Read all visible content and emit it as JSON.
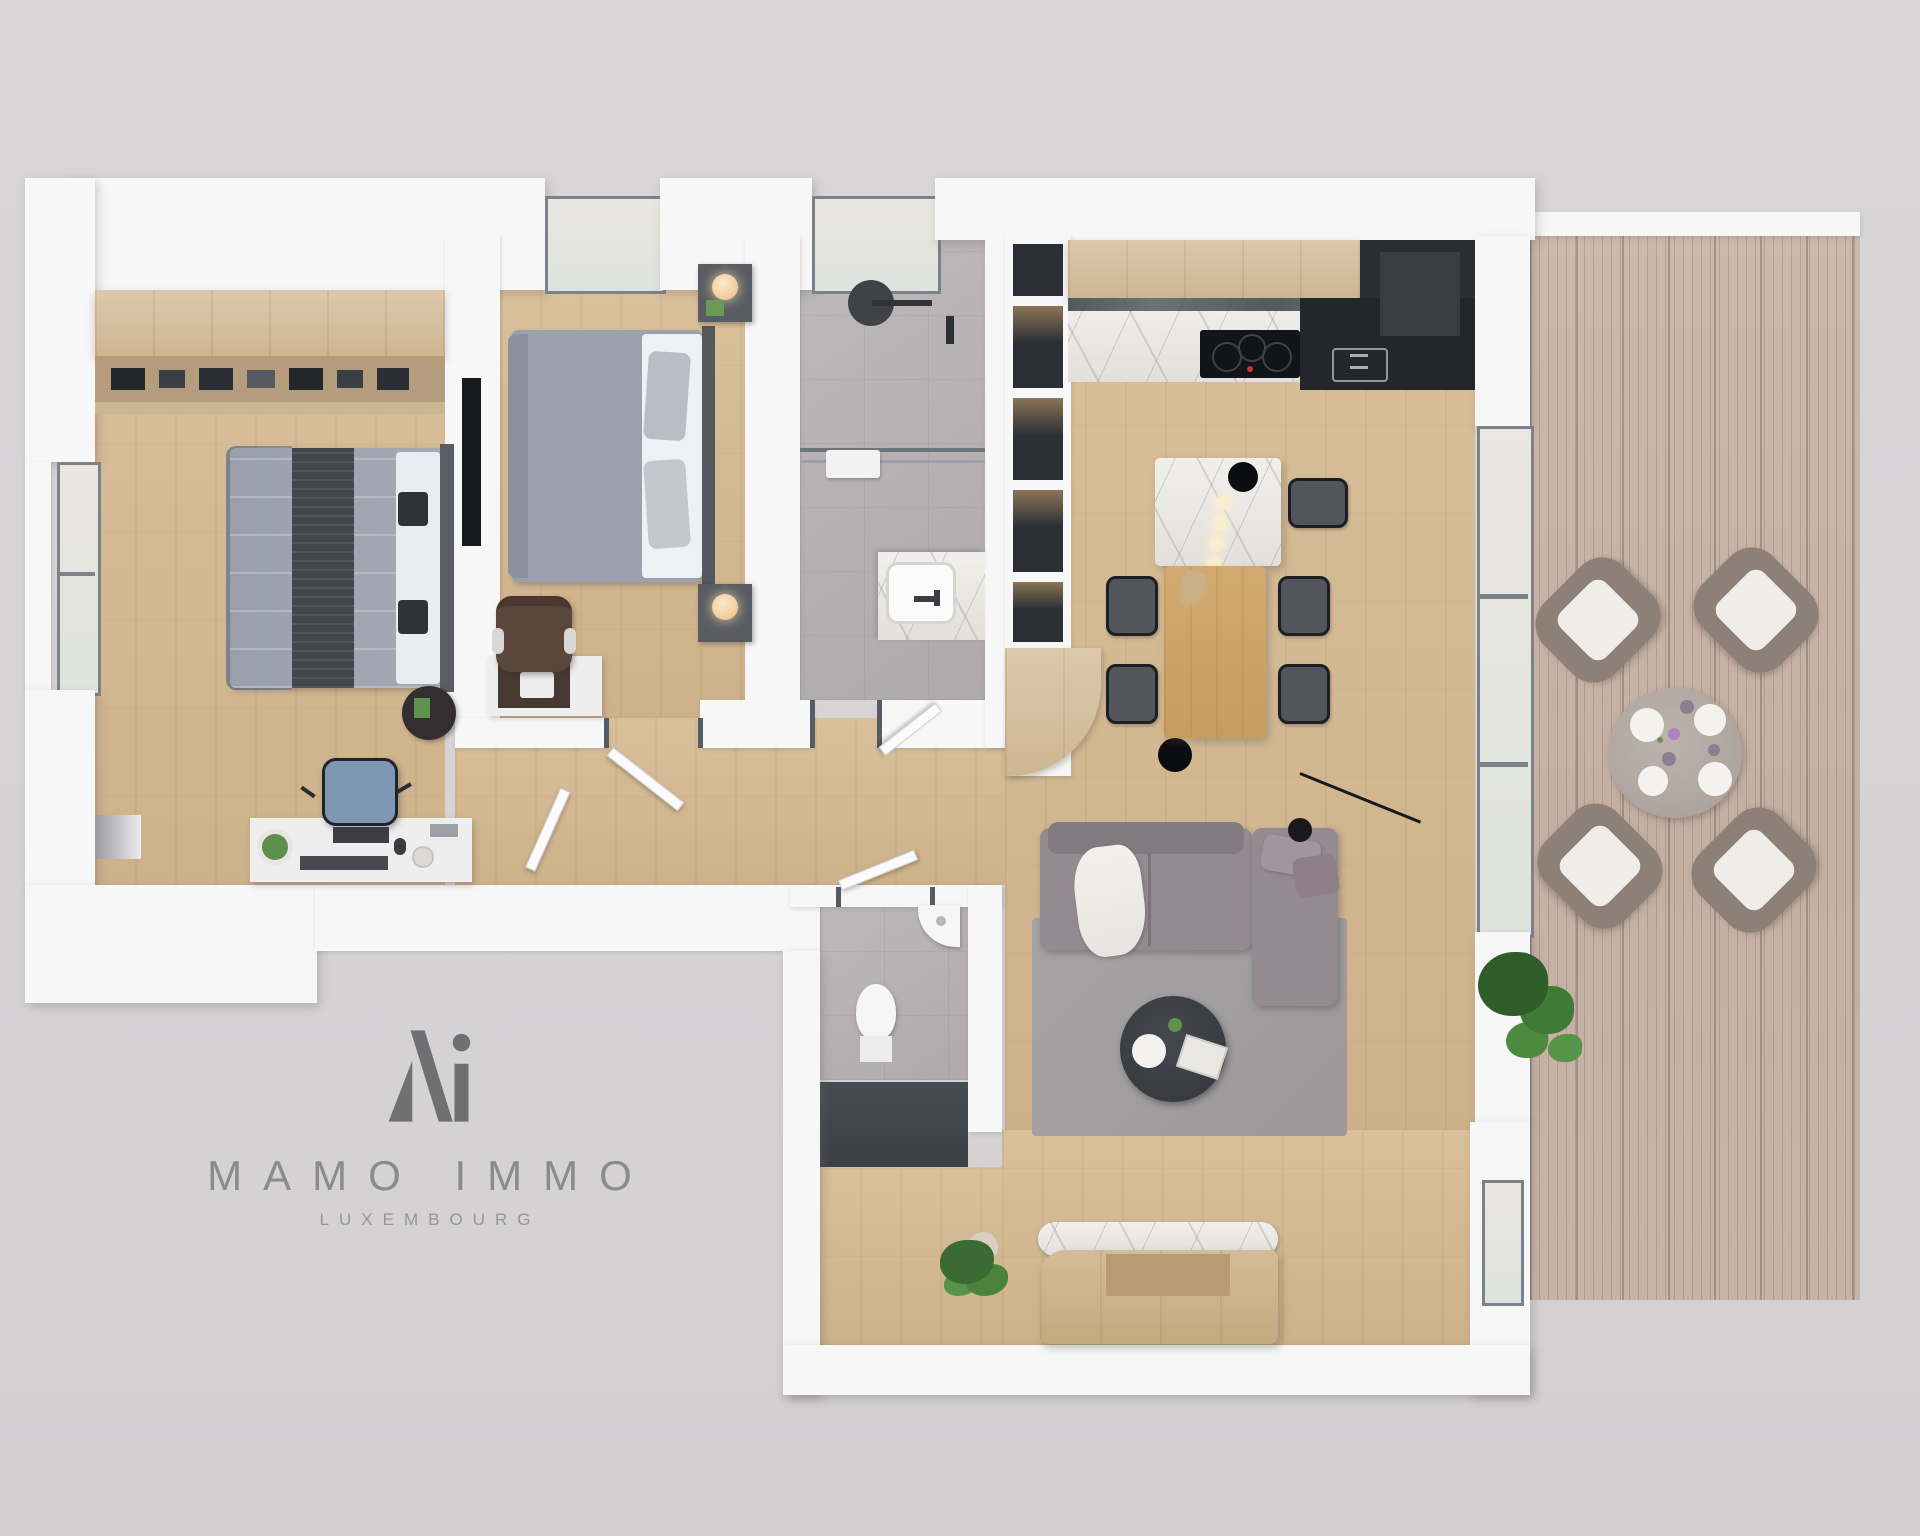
{
  "image": {
    "kind": "3d-floor-plan-render",
    "width": 1920,
    "height": 1536
  },
  "logo": {
    "mark": "Mi-monogram",
    "title": "MAMO IMMO",
    "subtitle": "LUXEMBOURG",
    "title_color": "#8b8b8d",
    "mark_color": "#707073"
  },
  "palette": {
    "background": "#d6d4d5",
    "wall": "#f7f7f8",
    "wood_floor": "#d3b88f",
    "terrace_deck": "#c6b1a3",
    "bathroom_tile": "#b7b3b4",
    "dark_kitchen_unit": "#23272c",
    "marble": "#ece9e5",
    "sofa_gray": "#948b91",
    "bed_linen_gray": "#9aa1ac",
    "office_chair_blue": "#7e98b4",
    "armchair_brown": "#5b463c",
    "dining_table_wood": "#cda36a",
    "plant_green": "#4b833d",
    "pendant_black": "#0c0d0f"
  },
  "scene": {
    "rooms": [
      {
        "name": "bedroom-1",
        "furniture": [
          "open-wardrobe-with-clothes",
          "double-bed-gray",
          "round-side-table",
          "desk-with-laptop",
          "blue-office-chair",
          "left-window"
        ]
      },
      {
        "name": "bedroom-2",
        "furniture": [
          "double-bed-gray",
          "nightstand-lamp-top",
          "nightstand-lamp-bottom",
          "wall-tv",
          "desk-dark-tray",
          "brown-armchair",
          "top-window"
        ]
      },
      {
        "name": "bathroom",
        "furniture": [
          "rain-shower",
          "glass-screen",
          "towel-rail",
          "vanity-sink",
          "top-window"
        ]
      },
      {
        "name": "hallway",
        "furniture": [
          "open-shelf-column",
          "curved-wood-cabinet",
          "open-doors"
        ]
      },
      {
        "name": "wc",
        "furniture": [
          "toilet",
          "corner-sink",
          "dark-storage-closet"
        ]
      },
      {
        "name": "kitchen-living",
        "furniture": [
          "upper-cabinets",
          "marble-counter",
          "induction-hob",
          "dark-corner-unit-with-sink",
          "marble-island",
          "pendant-light-string",
          "dining-table",
          "dining-chairs-x5",
          "corner-sofa-with-throw",
          "round-coffee-table",
          "rug",
          "floor-lamp"
        ]
      },
      {
        "name": "entrance",
        "furniture": [
          "wood-bench",
          "marble-bolster",
          "potted-plant"
        ]
      },
      {
        "name": "terrace",
        "furniture": [
          "wood-decking",
          "round-outdoor-table",
          "outdoor-armchairs-x4",
          "potted-plant"
        ]
      }
    ]
  }
}
